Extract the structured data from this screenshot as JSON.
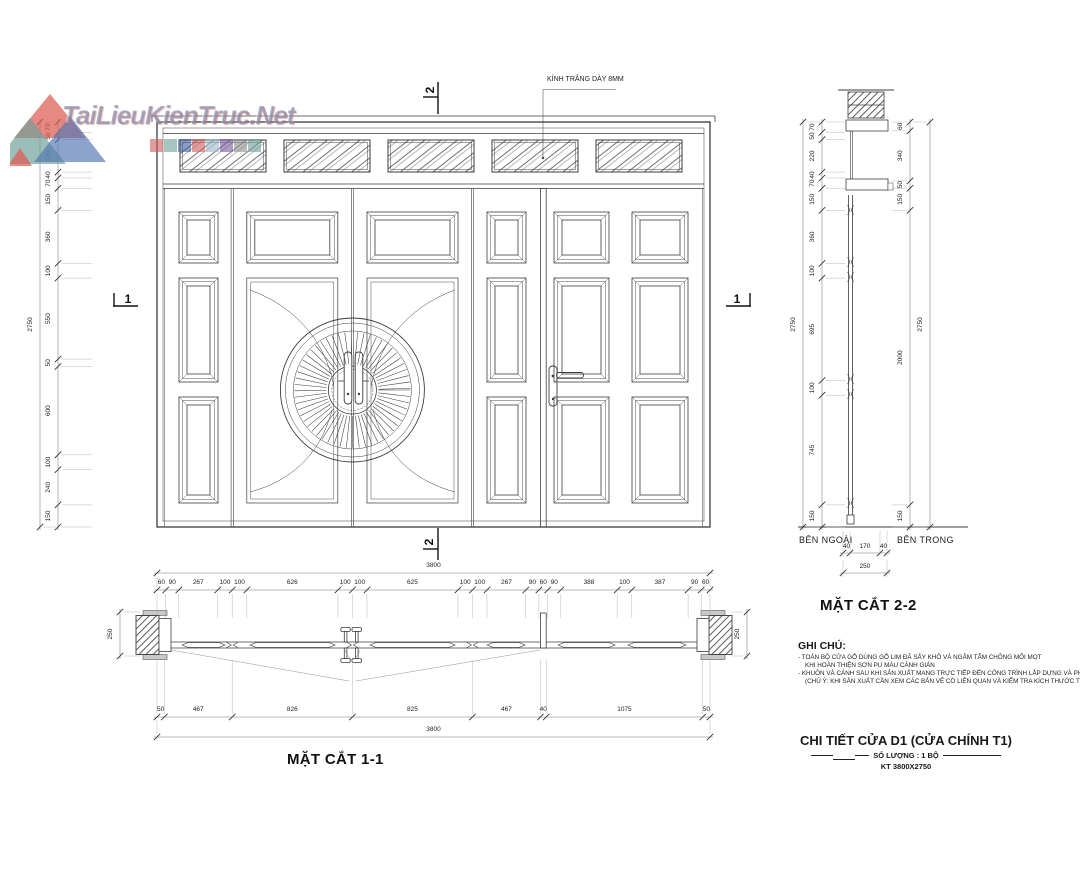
{
  "watermark": {
    "brand": "TaiLieuKienTruc.Net"
  },
  "labels": {
    "glass_note": "KÍNH TRẮNG DÀY 8MM",
    "marker1": "1",
    "marker2": "2",
    "outside": "BÊN NGOÀI",
    "inside": "BÊN TRONG",
    "section1_title": "MẶT CẮT 1-1",
    "section2_title": "MẶT CẮT 2-2"
  },
  "notes": {
    "heading": "GHI CHÚ:",
    "lines": [
      "- TOÀN BỘ CỬA GỖ DÙNG GỖ LIM ĐÃ SẤY KHÔ VÀ NGÂM TẨM CHỐNG MỐI MỌT",
      "KHI HOÀN THIỆN SƠN PU MÀU CÁNH GIÁN",
      "- KHUÔN VÀ CÁNH SAU KHI SẢN XUẤT MANG TRỰC TIẾP ĐẾN CÔNG TRÌNH LẮP DỰNG VÀ PHUN SƠN",
      "(CHÚ Ý: KHI SẢN XUẤT CẦN XEM CÁC BẢN VẼ CÓ LIÊN QUAN VÀ KIỂM TRA KÍCH THƯỚC THỰC TẾ TẠI HIỆN TRƯỜNG)"
    ]
  },
  "title_block": {
    "title": "CHI TIẾT CỬA D1 (CỬA CHÍNH T1)",
    "quantity": "SỐ LƯỢNG : 1 BỘ",
    "size": "KT 3800X2750"
  },
  "dimensions": {
    "elevation_left": [
      "70",
      "50",
      "220",
      "40",
      "70",
      "150",
      "360",
      "100",
      "550",
      "50",
      "600",
      "100",
      "240",
      "150"
    ],
    "elevation_left_total": "2750",
    "plan_top": [
      "60",
      "90",
      "267",
      "100",
      "100",
      "626",
      "100",
      "100",
      "625",
      "100",
      "100",
      "267",
      "90",
      "60",
      "90",
      "388",
      "100",
      "387",
      "90",
      "60"
    ],
    "plan_top_total": "3800",
    "plan_bottom": [
      "50",
      "467",
      "826",
      "825",
      "467",
      "40",
      "1075",
      "50"
    ],
    "plan_bottom_total": "3800",
    "plan_wall": "250",
    "section2_left": [
      "70",
      "50",
      "220",
      "40",
      "70",
      "150",
      "360",
      "100",
      "695",
      "100",
      "745",
      "150"
    ],
    "section2_left_total": "2750",
    "section2_right": [
      "60",
      "340",
      "50",
      "150",
      "2000",
      "150"
    ],
    "section2_right_total": "2750",
    "section2_bottom": [
      "40",
      "170",
      "40"
    ],
    "section2_bottom_total": "250"
  },
  "colors": {
    "line": "#3c3c3c",
    "dim": "#555555",
    "watermark_red": "#dd5c52",
    "watermark_blue": "#5577b3",
    "watermark_teal": "#6f9e98",
    "square_colors": [
      "#cf5f5f",
      "#6fa29b",
      "#44609e",
      "#cf5f5f",
      "#9db7c9",
      "#7c5d9e",
      "#8f8f8f",
      "#6fa29b"
    ]
  }
}
